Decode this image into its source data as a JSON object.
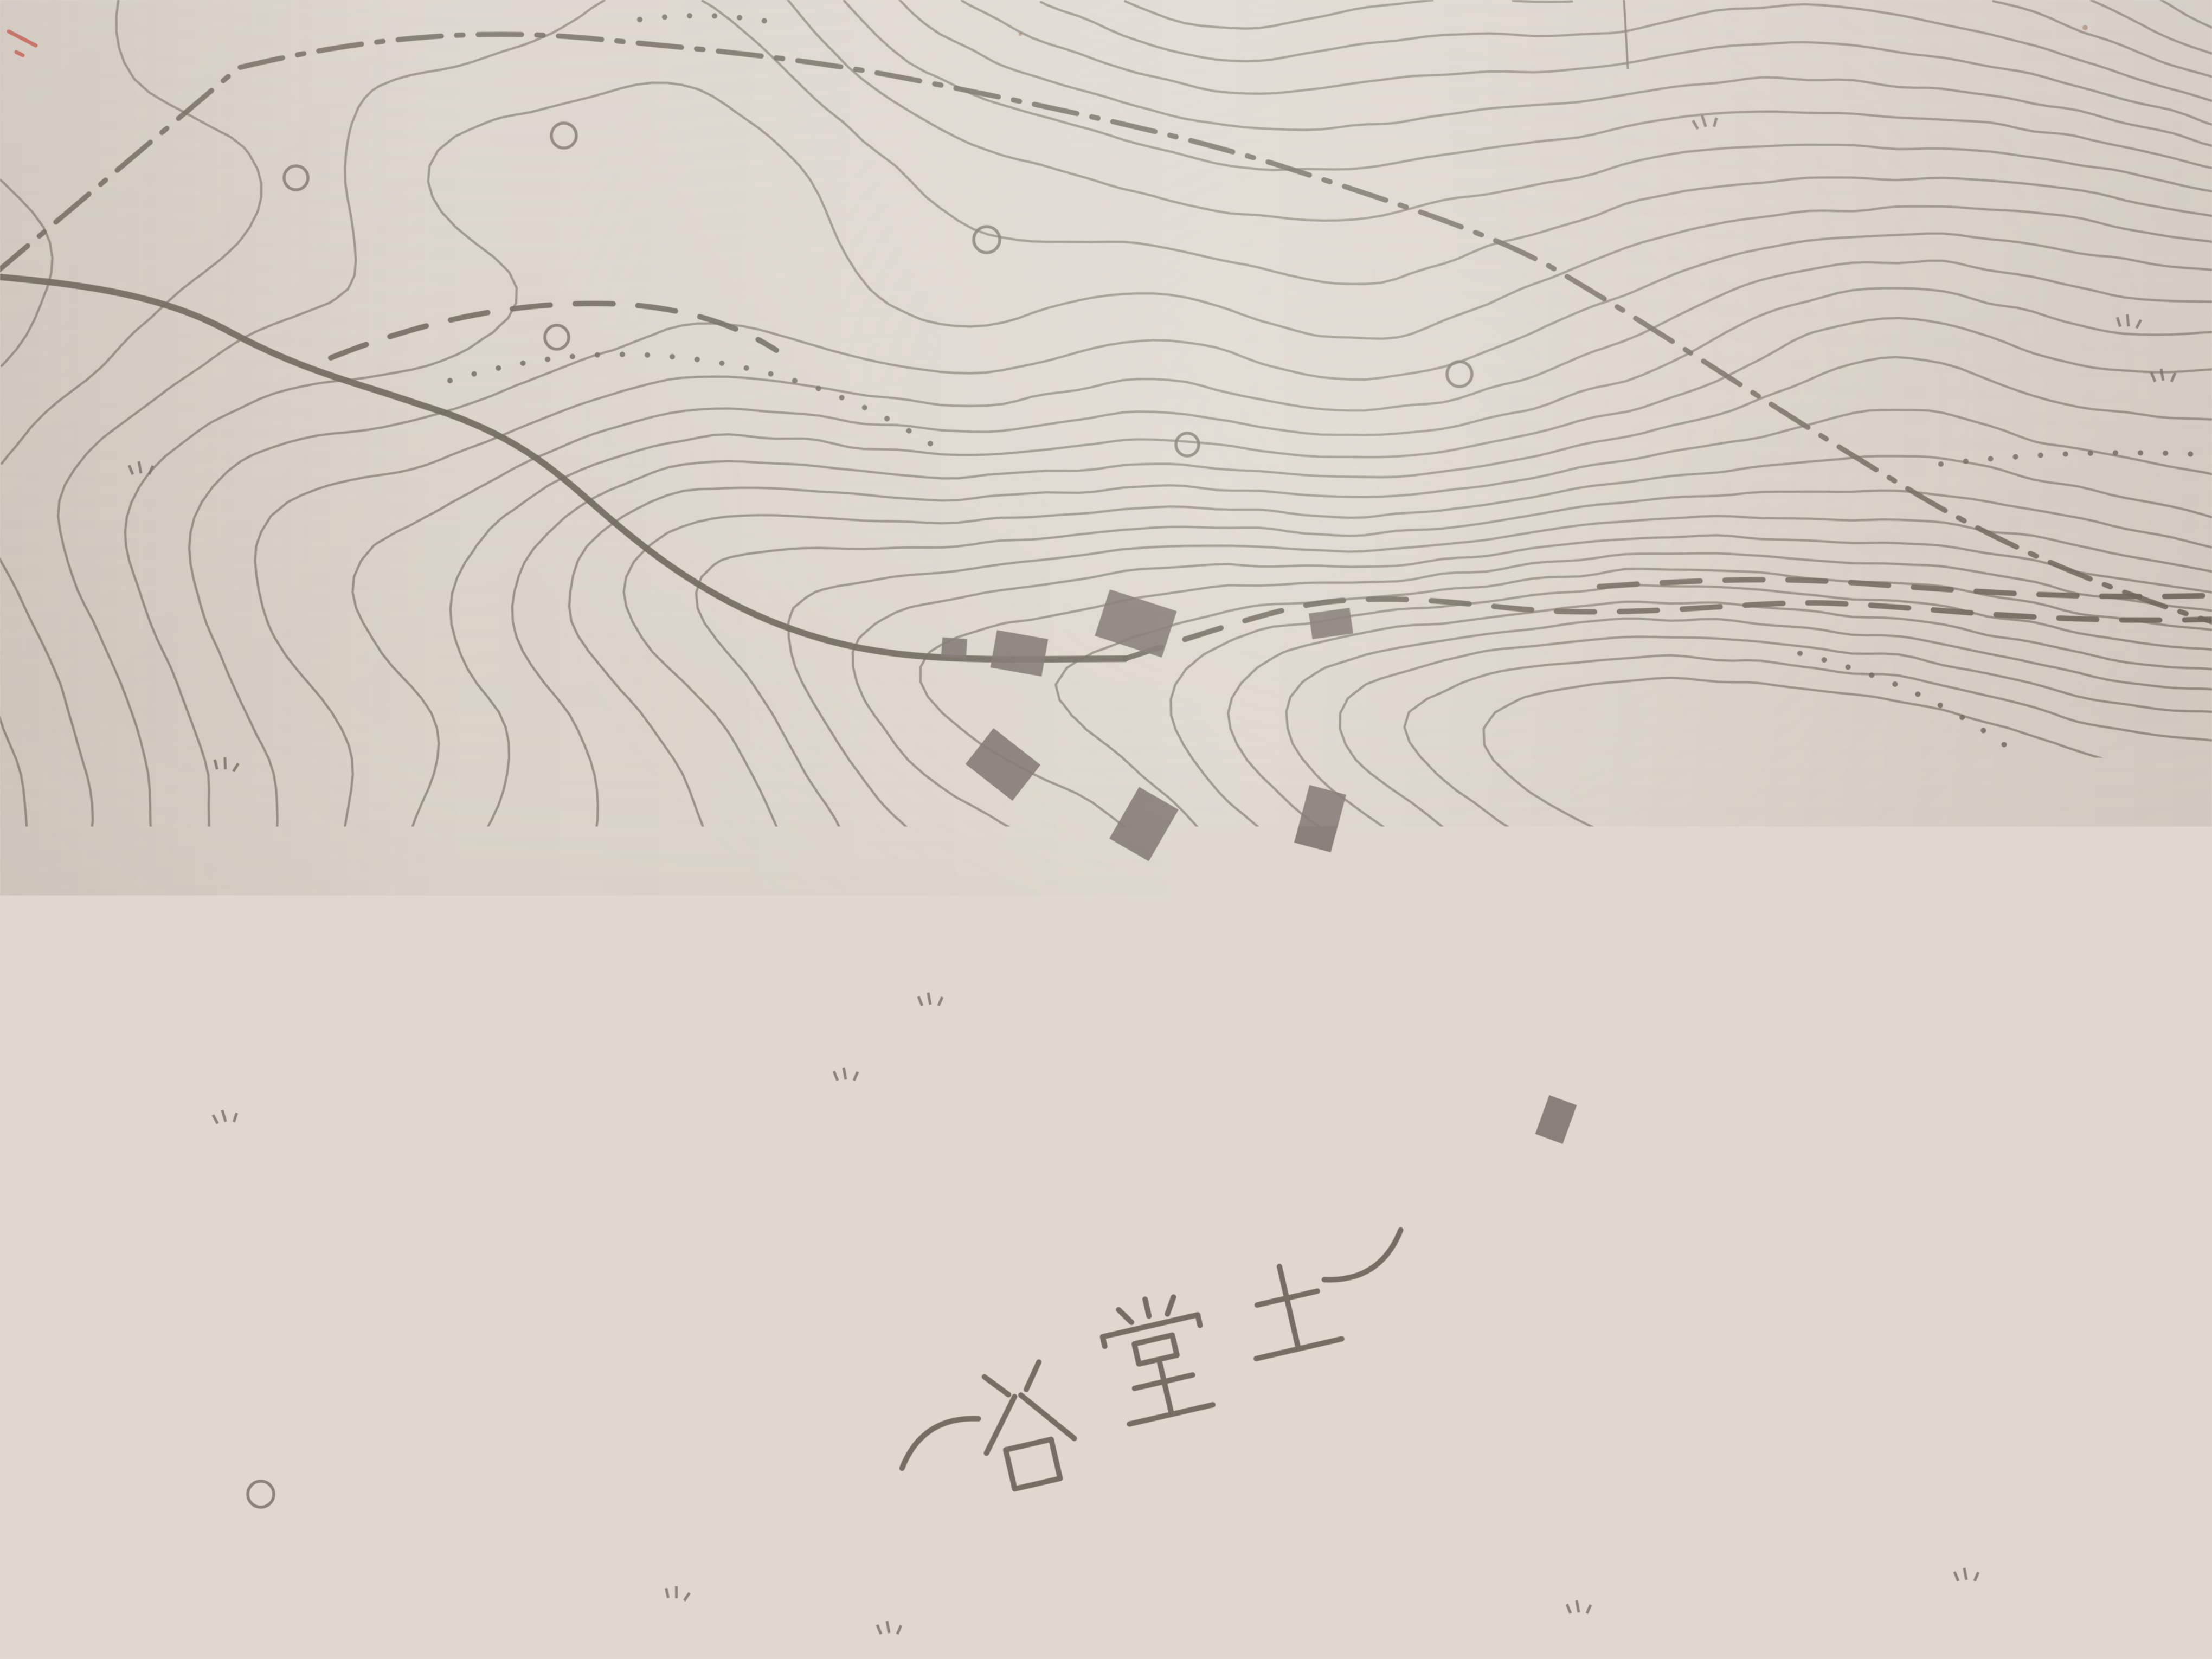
{
  "map": {
    "description": "photograph of an old Japanese topographic map sheet",
    "labels": {
      "plot_number": "19",
      "marker_character": "小",
      "place_name": "(谷堂土)"
    },
    "colors": {
      "paper_top": "#eae7e1",
      "paper_mid": "#ded8ce",
      "paper_bottom": "#b2a69b",
      "contour": "#8a8477",
      "ink": "#6f695d",
      "grid": "#857e70",
      "symbol": "#7b7468",
      "building": "#7e7770",
      "plot_number": "#d14b40",
      "marker_border": "#161616",
      "marker_fill": "#f2c3a4",
      "marker_ring": "#2e6b96",
      "marker_character": "#1f6f9e",
      "place_name": "#6a6255",
      "speck": "#8a5230"
    },
    "features": {
      "contour_lines": true,
      "grid_lines_vertical": 1,
      "grid_lines_horizontal": 1,
      "dash_dot_boundary_lines": 1,
      "dashed_roads": 6,
      "dotted_footpaths": 6,
      "stream_lines": 1,
      "building_symbols": 8,
      "circle_symbols": 7,
      "grass_tuft_symbols": 12
    }
  }
}
